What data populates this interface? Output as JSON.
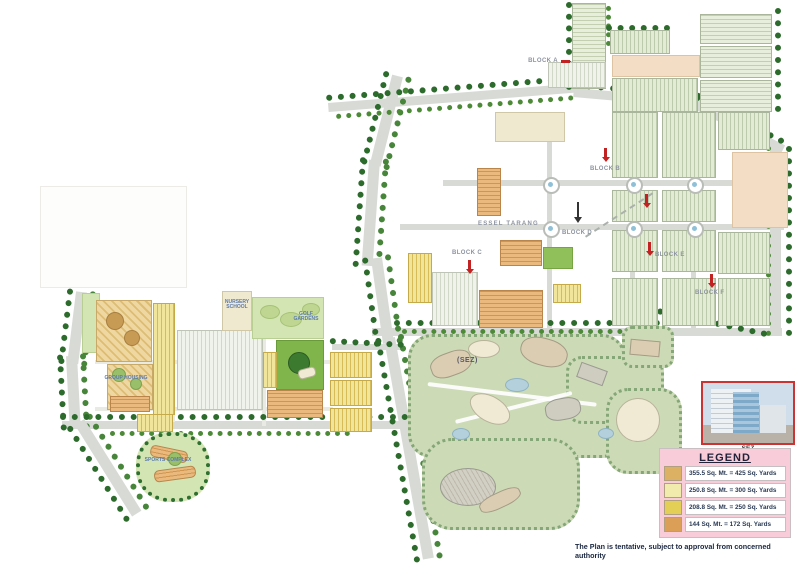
{
  "map": {
    "sez_area_label": "(SEZ)",
    "road_label": "ESSEL TARANG",
    "markers": [
      {
        "label": "BLOCK A"
      },
      {
        "label": "BLOCK B"
      },
      {
        "label": "BLOCK C"
      },
      {
        "label": "BLOCK D"
      },
      {
        "label": "BLOCK E"
      },
      {
        "label": "BLOCK F"
      }
    ],
    "area_labels": [
      {
        "text": "NURSERY SCHOOL"
      },
      {
        "text": "GOLF GARDENS"
      },
      {
        "text": "GROUP HOUSING"
      },
      {
        "text": "SPORTS COMPLEX"
      }
    ]
  },
  "legend": {
    "title": "LEGEND",
    "items": [
      {
        "swatch": "#ddb164",
        "label": "355.5 Sq. Mt. = 425 Sq. Yards"
      },
      {
        "swatch": "#f1ecad",
        "label": "250.8 Sq. Mt. = 300 Sq. Yards"
      },
      {
        "swatch": "#e3cf55",
        "label": "208.8 Sq. Mt. = 250 Sq. Yards"
      },
      {
        "swatch": "#db9f58",
        "label": "144 Sq. Mt. = 172 Sq. Yards"
      }
    ]
  },
  "sez_photo": {
    "caption": "SEZ"
  },
  "footer": {
    "disclaimer": "The Plan is tentative, subject to approval from concerned authority"
  },
  "colors": {
    "legend_bg": "#f8cdd9",
    "marker_red": "#c22222",
    "tree_green": "#2d6b2d",
    "road_grey": "#d8dad5"
  }
}
